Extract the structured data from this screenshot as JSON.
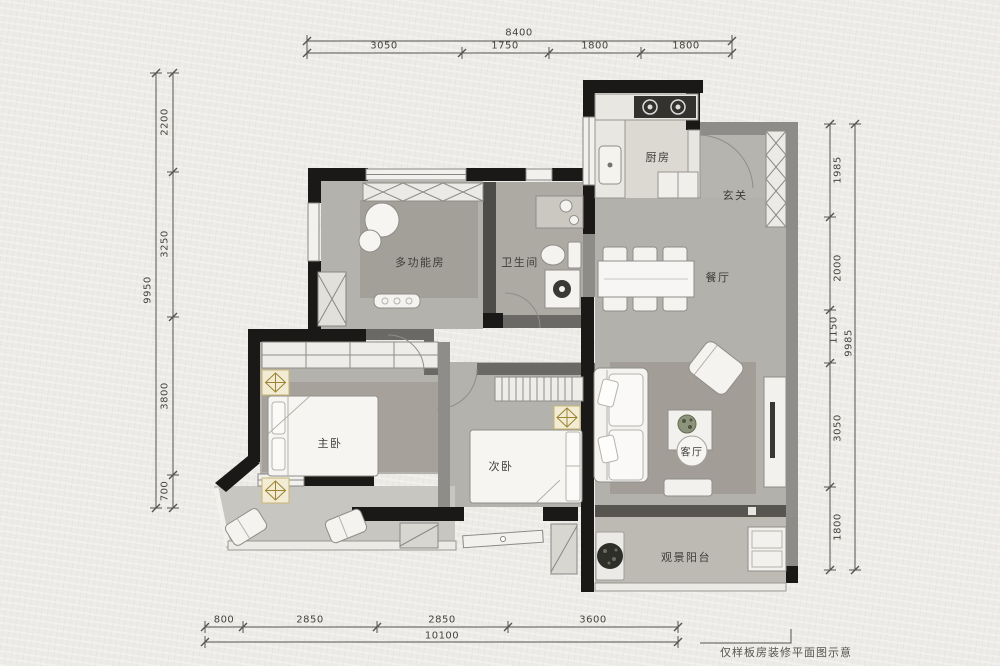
{
  "meta": {
    "footnote": "仅样板房装修平面图示意"
  },
  "palette": {
    "wall_black": "#1a1918",
    "wall_gray": "#8e8c88",
    "floor_gray": "#b3b1ac",
    "rug_gray": "#a29e97",
    "balcony_gray": "#c8c6c1",
    "furniture_white": "#f4f3f0",
    "accent_gold": "#9c8433",
    "paper": "#ecebe7"
  },
  "rooms": {
    "kitchen": "厨房",
    "entry": "玄关",
    "multi": "多功能房",
    "bath": "卫生间",
    "dining": "餐厅",
    "master": "主卧",
    "second": "次卧",
    "living": "客厅",
    "balcony": "观景阳台"
  },
  "dims": {
    "top": {
      "overall": "8400",
      "segments": [
        "3050",
        "1750",
        "1800",
        "1800"
      ]
    },
    "left": {
      "overall": "9950",
      "segments": [
        "2200",
        "3250",
        "3800",
        "700"
      ]
    },
    "right": {
      "overall": "9985",
      "segments": [
        "1985",
        "2000",
        "1150",
        "3050",
        "1800"
      ]
    },
    "bottom": {
      "overall": "10100",
      "segments": [
        "800",
        "2850",
        "2850",
        "3600"
      ]
    }
  }
}
